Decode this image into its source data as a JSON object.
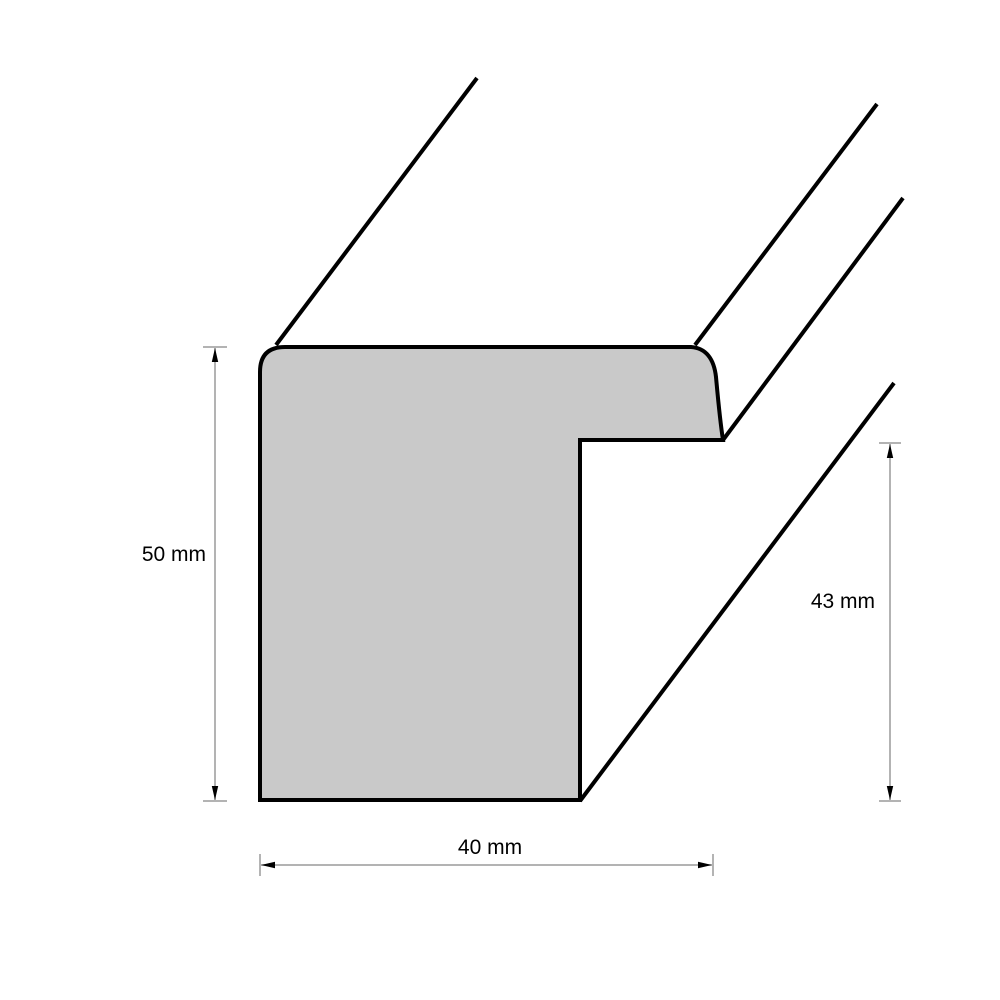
{
  "diagram": {
    "kind": "frame-moulding-profile-cross-section",
    "unit": "mm",
    "dimensions": {
      "height": {
        "label": "50 mm",
        "value": 50,
        "unit": "mm",
        "orientation": "vertical",
        "side": "left"
      },
      "rabbet_height": {
        "label": "43 mm",
        "value": 43,
        "unit": "mm",
        "orientation": "vertical",
        "side": "right"
      },
      "width": {
        "label": "40 mm",
        "value": 40,
        "unit": "mm",
        "orientation": "horizontal",
        "side": "bottom"
      }
    },
    "colors": {
      "shape_fill": "#c9c9c9",
      "outline": "#000000",
      "dimension_line": "#9a9a9a",
      "arrow": "#000000",
      "text": "#000000",
      "background": "#ffffff"
    }
  }
}
